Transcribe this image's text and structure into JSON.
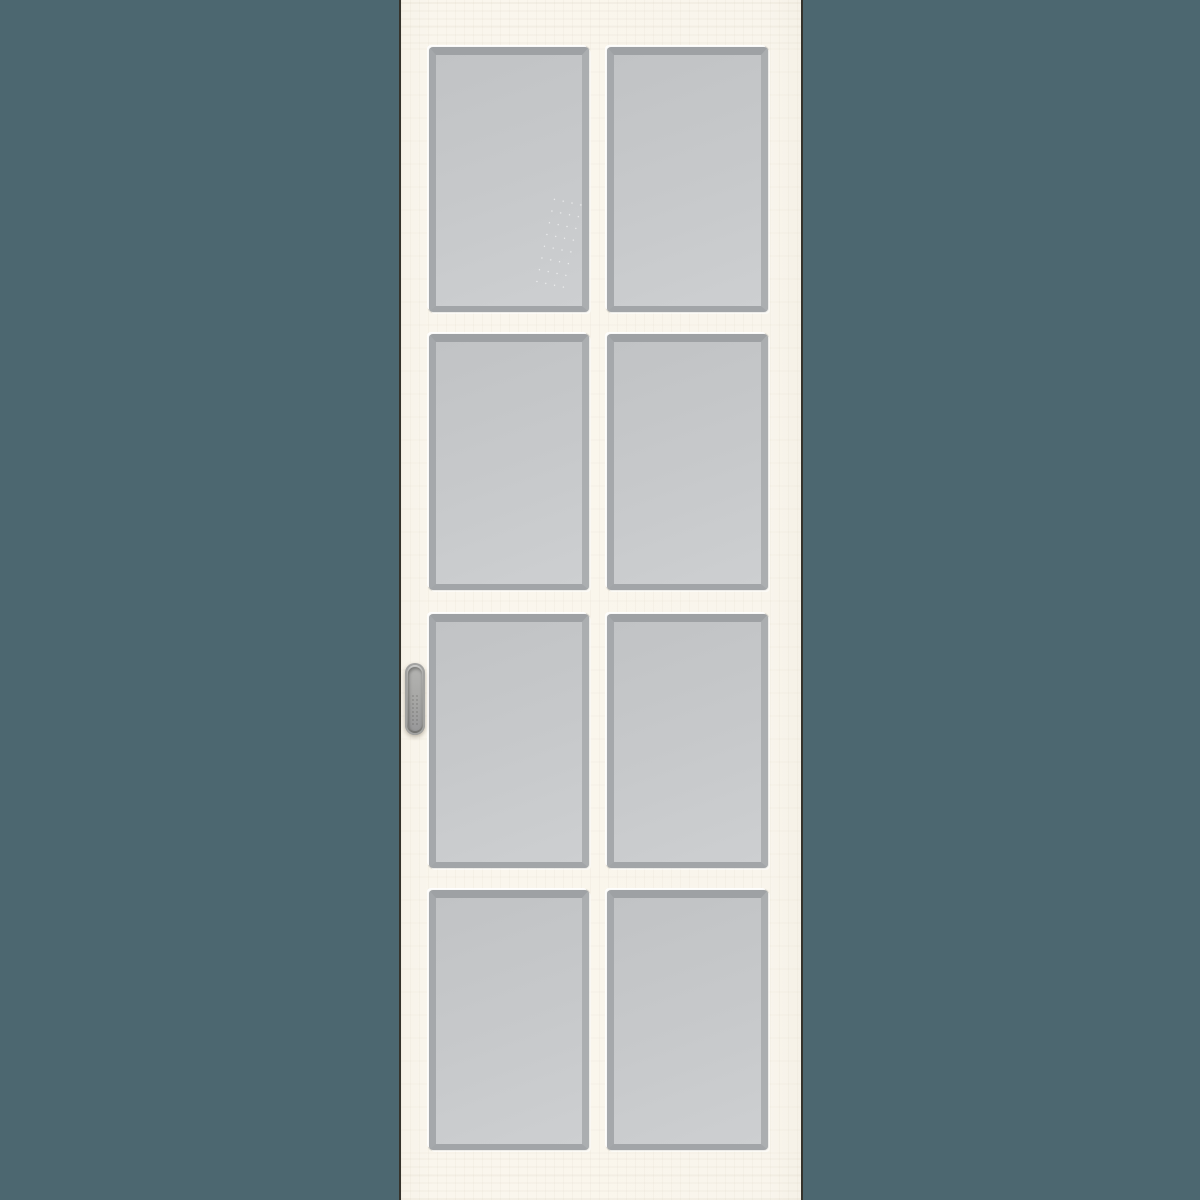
{
  "product": {
    "name": "sliding-interior-door",
    "description": "Cream white sliding interior door with eight frosted glass panes in two columns and four rows, and a recessed oval pull handle on the left stile",
    "glass_rows": 4,
    "glass_columns": 2,
    "pane_count": 8,
    "handle_type": "recessed flush pull"
  },
  "colors": {
    "background": "#4C6770",
    "door_face": "#F9F5EC",
    "door_edge_line": "#35332C",
    "glass_fill": "#C6C8CA",
    "glass_bevel": "#9EA1A4",
    "glass_highlight": "#FFFFFF",
    "handle_metal": "#A3A3A1"
  }
}
